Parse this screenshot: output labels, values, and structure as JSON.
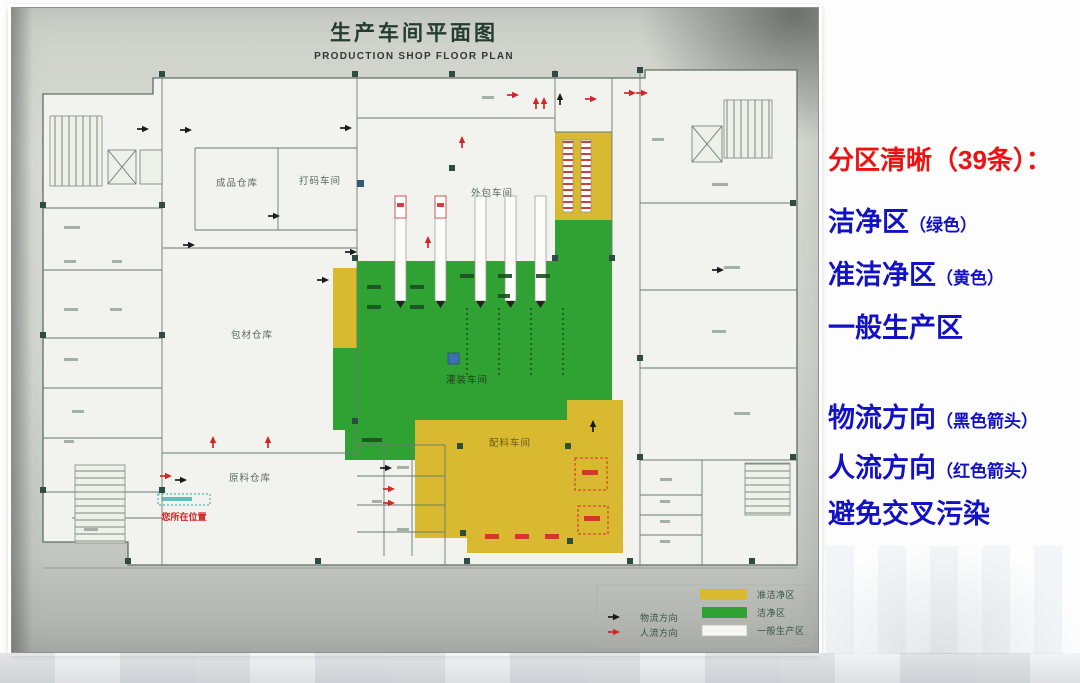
{
  "panel": {
    "heading": "分区清晰（39条）：",
    "items": [
      {
        "main": "洁净区",
        "note": "（绿色）"
      },
      {
        "main": "准洁净区",
        "note": "（黄色）"
      },
      {
        "main": "一般生产区",
        "note": ""
      },
      {
        "main": "物流方向",
        "note": "（黑色箭头）"
      },
      {
        "main": "人流方向",
        "note": "（红色箭头）"
      },
      {
        "main": "避免交叉污染",
        "note": ""
      }
    ],
    "colors": {
      "heading_red": "#ee1111",
      "body_blue": "#1212c4"
    }
  },
  "plan": {
    "title": "生产车间平面图",
    "subtitle": "PRODUCTION SHOP FLOOR PLAN",
    "rooms": {
      "finished_goods": "成品仓库",
      "coding": "打码车间",
      "outer_packing": "外包车间",
      "packing_material": "包材仓库",
      "raw_material": "原料仓库",
      "filling": "灌装车间",
      "batching": "配料车间"
    },
    "marker": "您所在位置",
    "legend": {
      "material_flow": "物流方向",
      "people_flow": "人流方向",
      "semi_clean": "准洁净区",
      "clean": "洁净区",
      "general": "一般生产区"
    },
    "colors": {
      "clean_green": "#2fa233",
      "semi_clean_yellow": "#d9b92f",
      "general_white": "#f6f7f3",
      "material_arrow": "#1a1a1a",
      "people_arrow": "#cf2727"
    }
  }
}
